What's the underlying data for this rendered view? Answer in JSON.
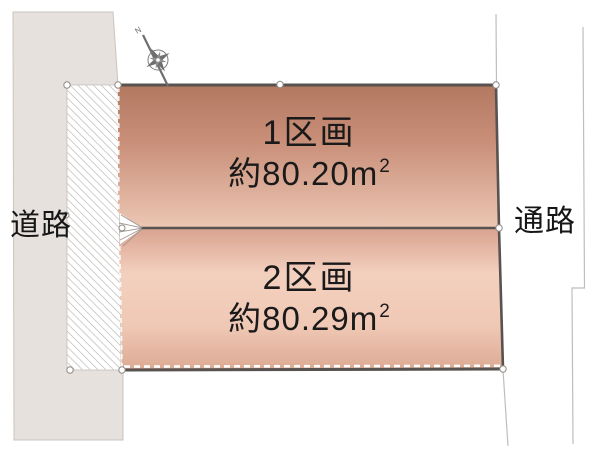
{
  "labels": {
    "road_left": "道路",
    "road_right": "通路"
  },
  "compass": {
    "north": "N"
  },
  "plots": [
    {
      "label": "1区画",
      "area_value": "約80.20",
      "area_unit": "m",
      "area_exponent": "2"
    },
    {
      "label": "2区画",
      "area_value": "約80.29",
      "area_unit": "m",
      "area_exponent": "2"
    }
  ],
  "colors": {
    "road-fill": "#e6e1dd",
    "road-border": "#c9c4bf",
    "hatch-line": "#b3aeaa",
    "plot1-grad-top": "#b27860",
    "plot1-grad-mid": "#c98f79",
    "plot1-grad-bottom": "#ecc7b4",
    "plot2-grad-top": "#d9a28f",
    "plot2-grad-light": "#f3d0be",
    "plot2-grad-low": "#f0c9b6",
    "plot2-grad-bottom": "#dcaa93",
    "border-dark": "#585350",
    "marker-stroke": "#8f8a85",
    "ext-line": "#c2bdb8",
    "compass-gray": "#6f6f6f",
    "text-color": "#1a1a1a"
  }
}
